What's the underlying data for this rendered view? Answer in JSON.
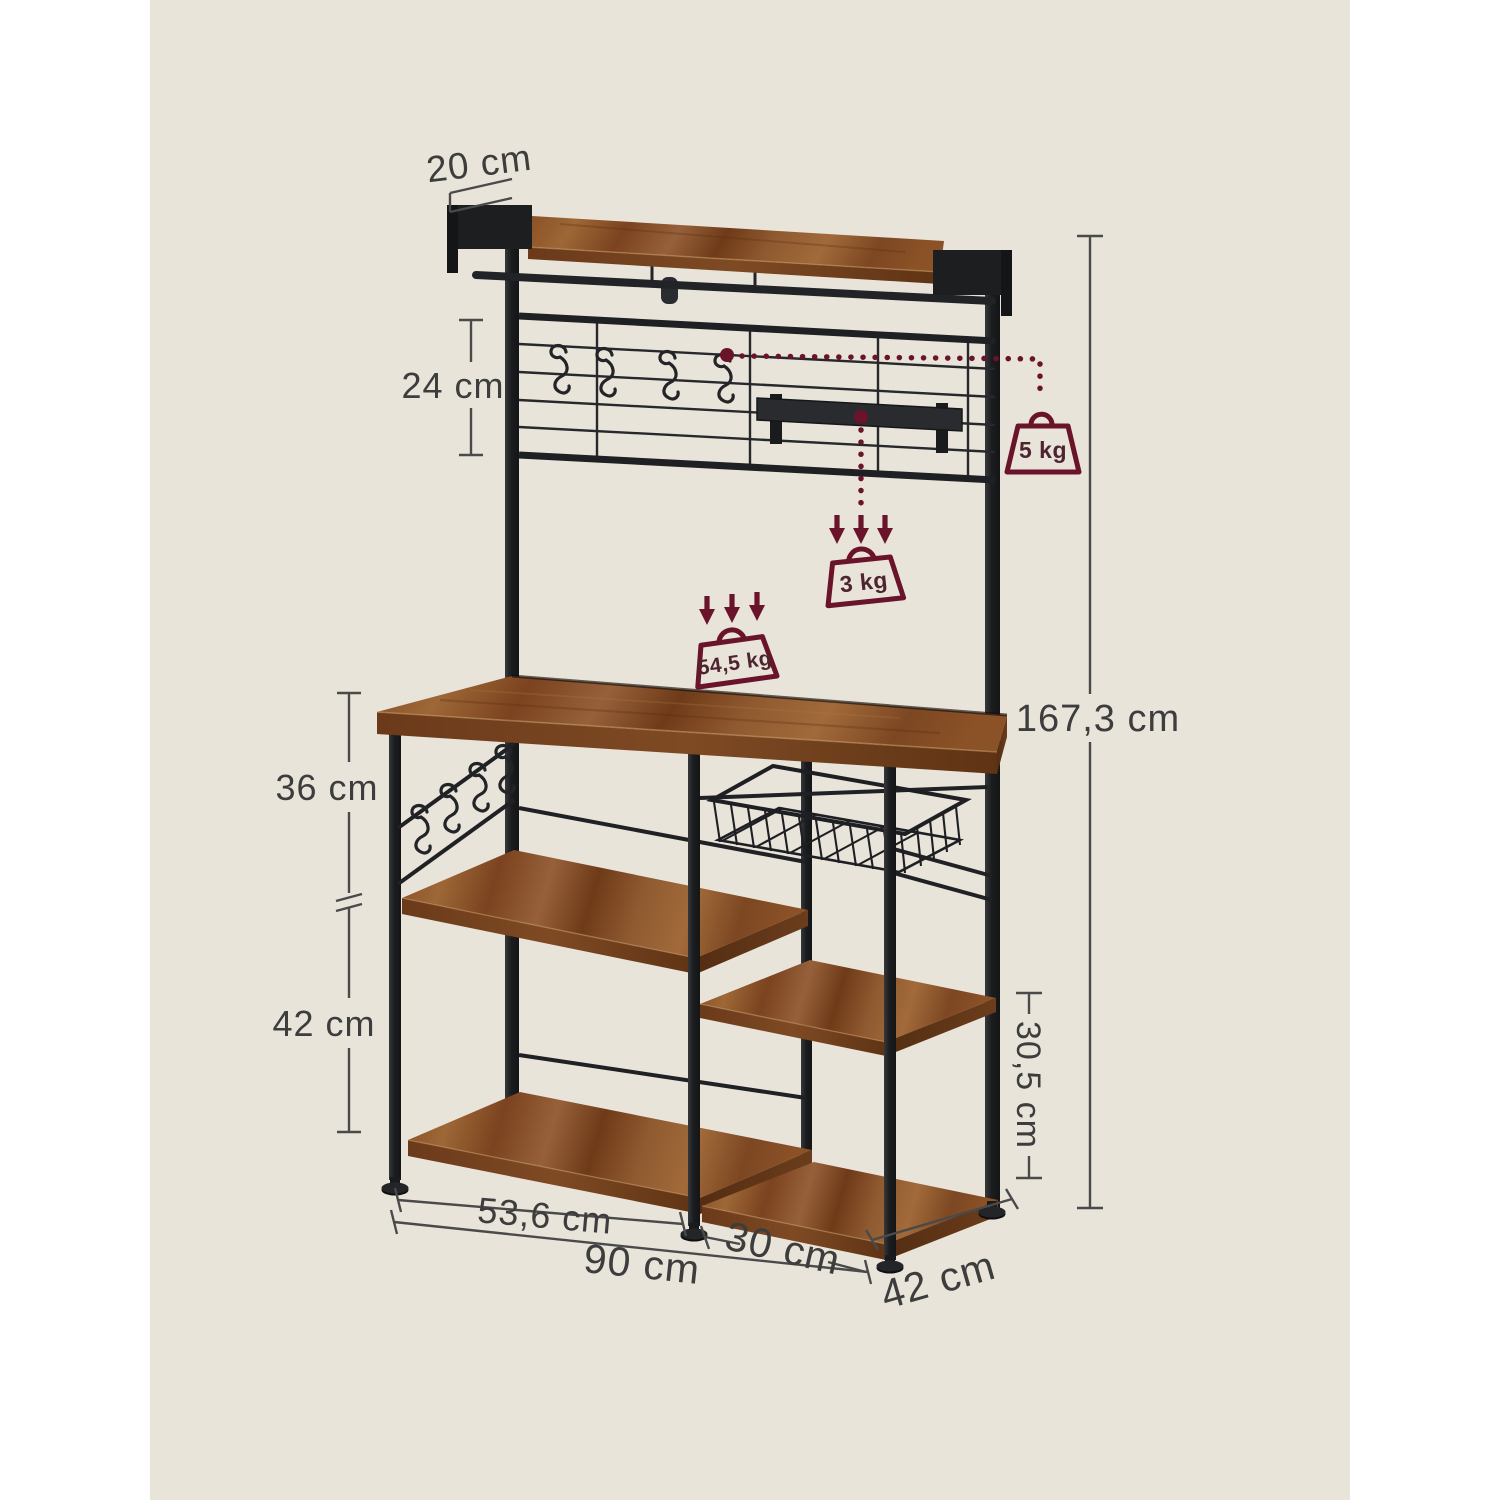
{
  "image_type": "product dimension diagram",
  "product": {
    "name": "industrial bakers rack with hutch",
    "wood_color": "#8a5026",
    "metal_color": "#1f2023"
  },
  "canvas": {
    "background": "#ffffff",
    "panel_background": "#e9e4da"
  },
  "annotation_colors": {
    "dimension_text": "#3d3d3d",
    "dimension_line": "#4a4a4a",
    "load_accent": "#69142b"
  },
  "dimensions": {
    "top_shelf_depth": "20 cm",
    "grid_panel_height": "24 cm",
    "worktop_to_middle_shelf": "36 cm",
    "middle_to_bottom_shelf": "42 cm",
    "left_compartment_width": "53,6 cm",
    "total_width": "90 cm",
    "right_compartment_width": "30 cm",
    "total_depth": "42 cm",
    "right_shelf_clearance": "30,5 cm",
    "total_height": "167,3 cm"
  },
  "load_capacities": {
    "grid_hook": "5 kg",
    "hanging_rail": "3 kg",
    "worktop": "54,5 kg"
  }
}
